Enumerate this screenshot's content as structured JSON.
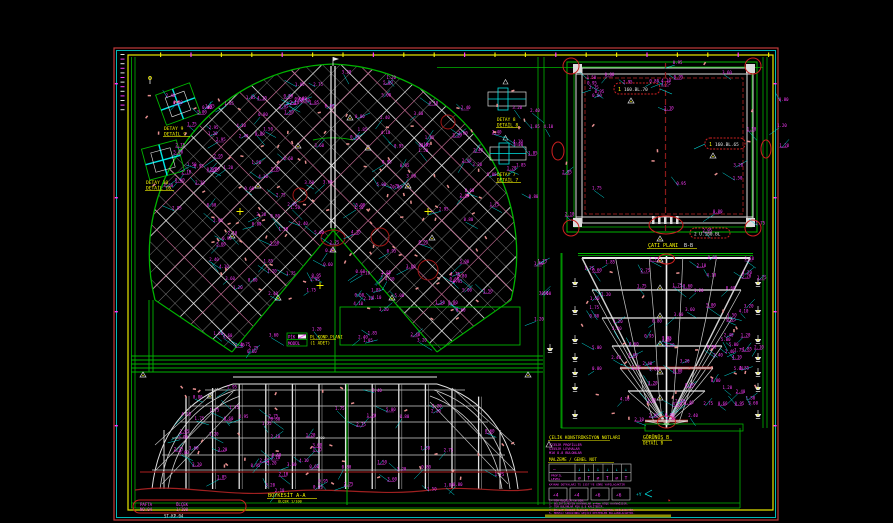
{
  "sheet": {
    "title": "steel-roof-construction-drawing",
    "background": "#000000",
    "frame_colors": {
      "outer": "#c03a3a",
      "mid": "#00b8b8",
      "inner": "#e8e800"
    },
    "palette": {
      "green": "#00b400",
      "white": "#e0e0e0",
      "gray": "#b4b4b4",
      "magenta": "#ff3cff",
      "cyan": "#00e5e5",
      "yellow": "#f5f500",
      "red": "#ff2222",
      "darkred": "#8b1a1a",
      "rose": "#cc6090",
      "salmon": "#e89090",
      "olive": "#8f8f00"
    }
  },
  "labels": {
    "detail9": {
      "l1": "DETAY 9",
      "l2": "DETAİL 9"
    },
    "detail10": {
      "l1": "DETAY 10",
      "l2": "DETAİL 10"
    },
    "detail8": {
      "l1": "DETAY 8",
      "l2": "DETAİL 8"
    },
    "detail7": {
      "l1": "DETAY 7",
      "l2": "DETAİL 7"
    },
    "plan_legend": {
      "c1": "PİK",
      "c2": "MODÜL",
      "t1": "PL.KONP.PLANI",
      "t2": "(1 ADET)"
    },
    "roof_plan": {
      "t1": "ÇATI PLANI",
      "t2": "B-B"
    },
    "cloud1": "160.BL.70",
    "cloud2": "160.BL.65",
    "cloud3": "2 U.160.BL",
    "section_b": {
      "l1": "GÖRÜNÜŞ B",
      "l2": "DETAİL B"
    },
    "elevation": {
      "l1": "BOYKESİT  A-A",
      "l2": "ÖLÇEK 1/100"
    },
    "sheet_tag": {
      "m1": "PAFTA",
      "m2": "NO:04",
      "m3": "ÖLÇEK",
      "m4": "1/100",
      "w1": "ST-KP-04"
    }
  },
  "notes": {
    "h1": "ÇELİK KONSTRÜKSİYON NOTLARI",
    "m1": "S235JR PROFİLLER",
    "m2": "S355JR LEVHALAR",
    "m3": "M16 8.8 BULONLAR",
    "h2": "MALZEME / GENEL NOT",
    "row1_left": "—",
    "row2_left1": "PROFİL",
    "row2_left2": "LEVHA",
    "table_row1": [
      "↓",
      "↓",
      "↓",
      "↓",
      "↓",
      "↓"
    ],
    "table_row2": [
      "⌀",
      "T",
      "⌀",
      "T",
      "⌀",
      "T"
    ],
    "caption": "KAYNAK DETAYLARI TS 3357'YE GÖRE YAPILACAKTIR",
    "weld_boxes": [
      "∠4",
      "∠4",
      "∠6",
      "∠6"
    ],
    "axis": "+Y",
    "n1": "1- TÜM ÖLÇÜLER cm DİR.",
    "n2": "2- BELİRTİLMEYEN KAYNAKLAR a=4mm KÖŞE KAYNAĞIDIR.",
    "n3": "3- TÜM BULONLAR M16 8.8 KALİTEDİR.",
    "n4": "4- İMALAT ÖNCESİ ÖLÇÜLER YERİNDE KONTROL EDİLECEKTİR.",
    "n5": "5- MONTAJ SIRASINDA GEÇİCİ DESTEKLER KULLANILACAKTIR."
  },
  "scatter": {
    "dim_texts": [
      "2.40",
      "1.85",
      "3.20",
      "0.95",
      "1.20",
      "4.10",
      "2.75",
      "0.60",
      "3.60",
      "1.50",
      "2.10",
      "5.00",
      "1.75",
      "2.95",
      "0.80"
    ],
    "label_regions": [
      {
        "name": "fan-left-wing",
        "x": 205,
        "y": 95,
        "w": 125,
        "h": 205,
        "n": 52
      },
      {
        "name": "fan-right-wing",
        "x": 345,
        "y": 95,
        "w": 150,
        "h": 225,
        "n": 58
      },
      {
        "name": "fan-top",
        "x": 280,
        "y": 70,
        "w": 110,
        "h": 34,
        "n": 12
      },
      {
        "name": "fan-left-outer",
        "x": 162,
        "y": 95,
        "w": 55,
        "h": 125,
        "n": 9
      },
      {
        "name": "fan-bottom-band",
        "x": 205,
        "y": 330,
        "w": 255,
        "h": 26,
        "n": 13
      },
      {
        "name": "mid-strip",
        "x": 528,
        "y": 100,
        "w": 18,
        "h": 245,
        "n": 7
      },
      {
        "name": "roof-plan-rect",
        "x": 556,
        "y": 62,
        "w": 212,
        "h": 172,
        "n": 24
      },
      {
        "name": "trapezoid",
        "x": 578,
        "y": 258,
        "w": 180,
        "h": 165,
        "n": 78
      },
      {
        "name": "elevation",
        "x": 150,
        "y": 382,
        "w": 368,
        "h": 110,
        "n": 58
      },
      {
        "name": "details-top-left",
        "x": 145,
        "y": 82,
        "w": 68,
        "h": 105,
        "n": 11
      },
      {
        "name": "details-right",
        "x": 480,
        "y": 85,
        "w": 52,
        "h": 92,
        "n": 9
      },
      {
        "name": "right-margin",
        "x": 770,
        "y": 75,
        "w": 16,
        "h": 150,
        "n": 3
      }
    ],
    "tick_regions": [
      {
        "x": 205,
        "y": 95,
        "w": 125,
        "h": 205,
        "n": 40
      },
      {
        "x": 345,
        "y": 95,
        "w": 150,
        "h": 225,
        "n": 45
      },
      {
        "x": 578,
        "y": 258,
        "w": 180,
        "h": 165,
        "n": 26
      },
      {
        "x": 150,
        "y": 382,
        "w": 368,
        "h": 105,
        "n": 30
      },
      {
        "x": 145,
        "y": 82,
        "w": 68,
        "h": 105,
        "n": 8
      },
      {
        "x": 480,
        "y": 85,
        "w": 52,
        "h": 92,
        "n": 6
      },
      {
        "x": 556,
        "y": 62,
        "w": 212,
        "h": 170,
        "n": 8
      }
    ]
  }
}
